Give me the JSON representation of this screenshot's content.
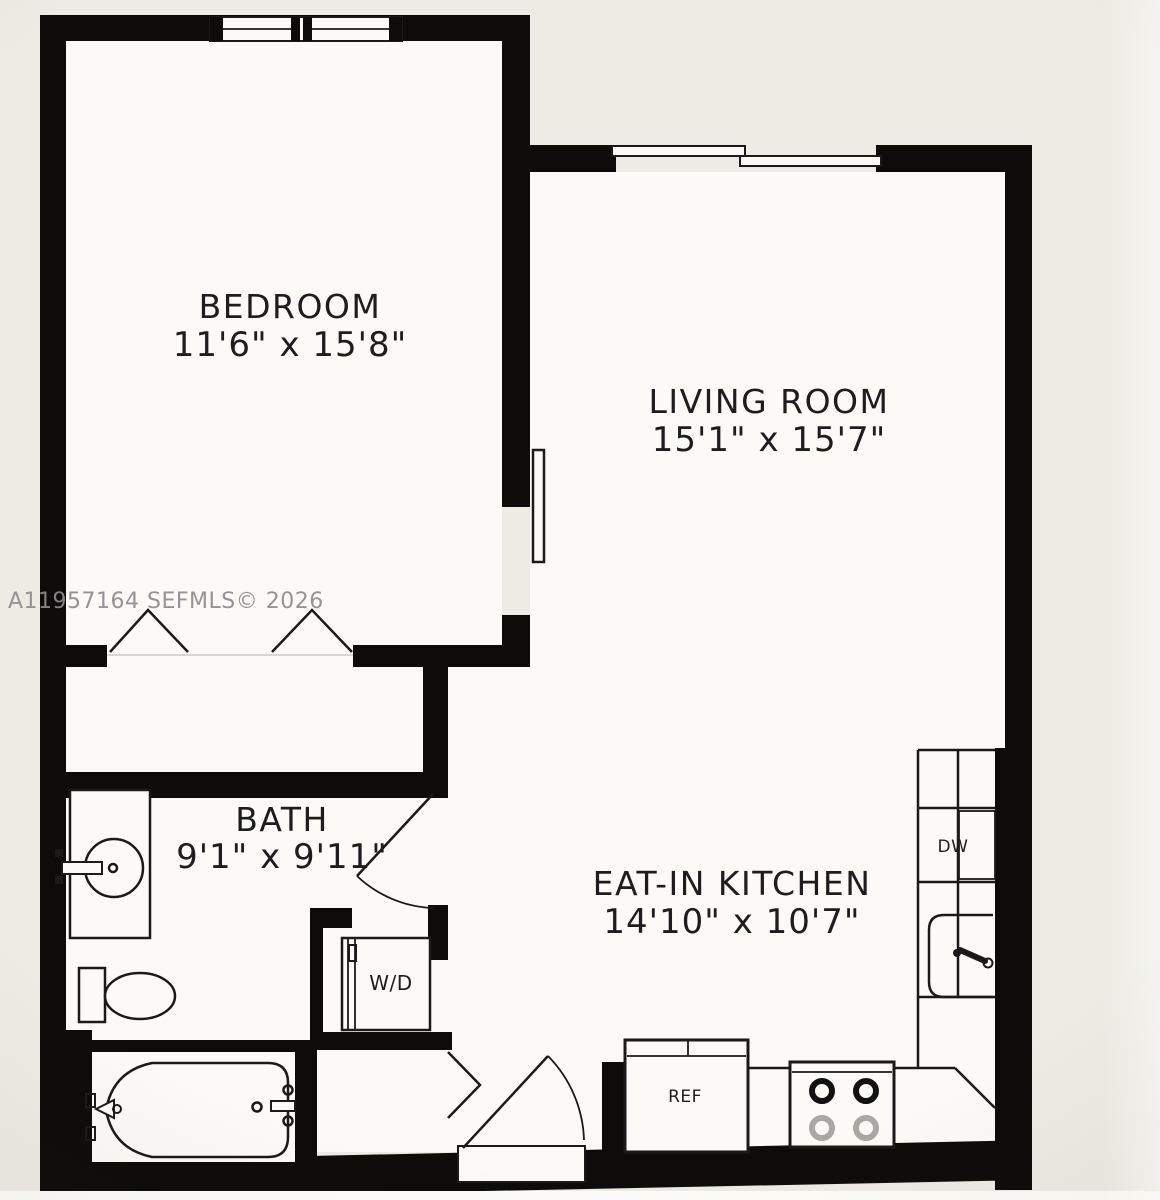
{
  "plan": {
    "watermark": "A11957164 SEFMLS© 2026",
    "rooms": [
      {
        "name": "BEDROOM",
        "dims": "11'6\" x 15'8\""
      },
      {
        "name": "LIVING ROOM",
        "dims": "15'1\" x 15'7\""
      },
      {
        "name": "BATH",
        "dims": "9'1\" x 9'11\""
      },
      {
        "name": "EAT-IN KITCHEN",
        "dims": "14'10\" x 10'7\""
      }
    ],
    "appliances": {
      "dishwasher": "DW",
      "washer_dryer": "W/D",
      "refrigerator": "REF"
    },
    "colors": {
      "wall": "#0d0c0a",
      "floor": "#fbfaf6",
      "background": "#ecebe4",
      "watermark": "#8c8c90"
    }
  }
}
